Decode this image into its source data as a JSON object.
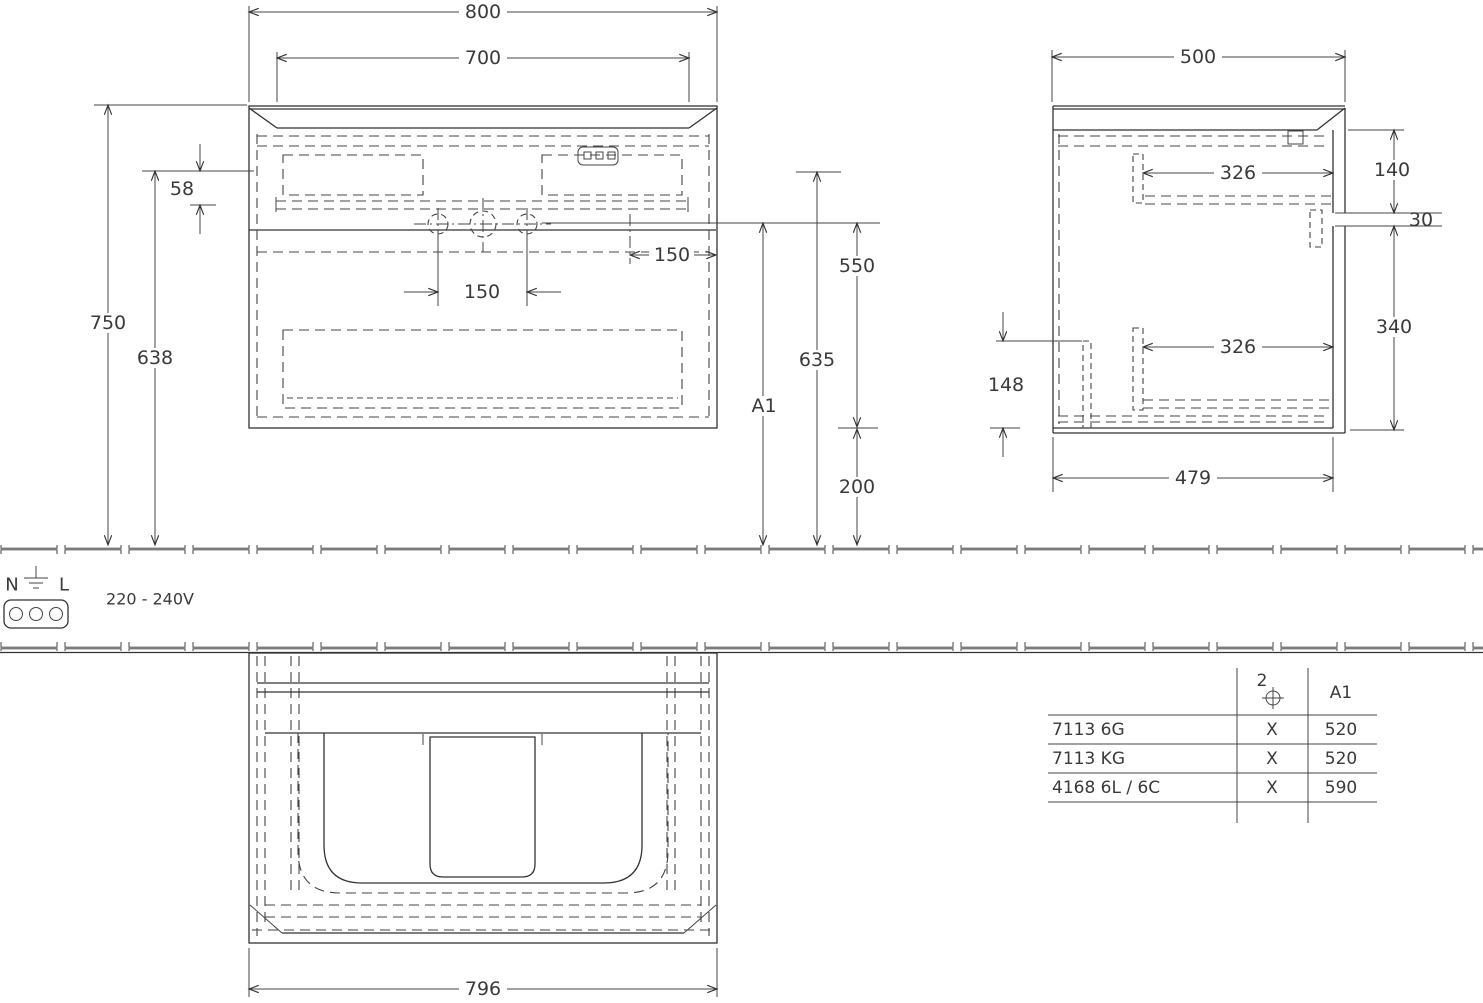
{
  "title": "Vanity unit technical drawing",
  "colors": {
    "line": "#333333",
    "background": "#ffffff",
    "text": "#3a3a3a"
  },
  "front": {
    "width_outer": "800",
    "width_inner": "700",
    "height_total": "750",
    "height_under_top": "638",
    "offset_top": "58",
    "tap_spacing": "150",
    "tap_edge_offset": "150",
    "height_tap": "550",
    "height_mid": "635",
    "height_var": "A1",
    "height_bottom": "200"
  },
  "side": {
    "depth": "500",
    "inner_upper": "326",
    "front_top": "140",
    "gap": "30",
    "inner_lower": "326",
    "rear_clear": "148",
    "front_lower": "340",
    "depth_body": "479"
  },
  "plan": {
    "width": "796"
  },
  "power": {
    "n": "N",
    "l": "L",
    "voltage": "220 - 240V"
  },
  "table": {
    "header_holes": "2",
    "header_a1": "A1",
    "rows": [
      {
        "model": "7113 6G",
        "holes": "X",
        "a1": "520"
      },
      {
        "model": "7113 KG",
        "holes": "X",
        "a1": "520"
      },
      {
        "model": "4168 6L / 6C",
        "holes": "X",
        "a1": "590"
      }
    ]
  }
}
